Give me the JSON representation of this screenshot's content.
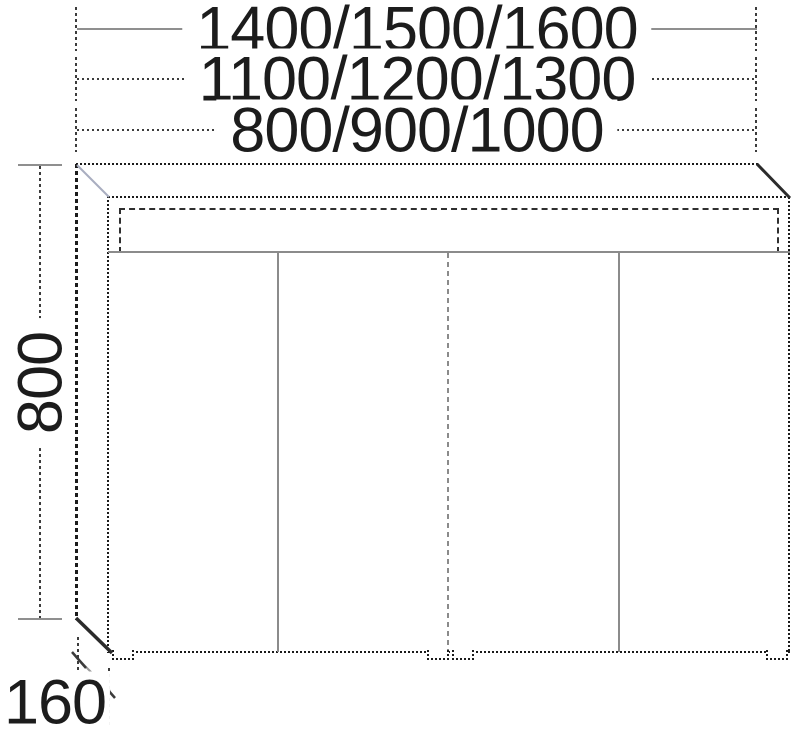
{
  "drawing": {
    "type": "furniture-elevation-technical-drawing",
    "width_rows": [
      {
        "label": "1400/1500/1600"
      },
      {
        "label": "1100/1200/1300"
      },
      {
        "label": "800/900/1000"
      }
    ],
    "height_label": "800",
    "depth_label": "160"
  }
}
